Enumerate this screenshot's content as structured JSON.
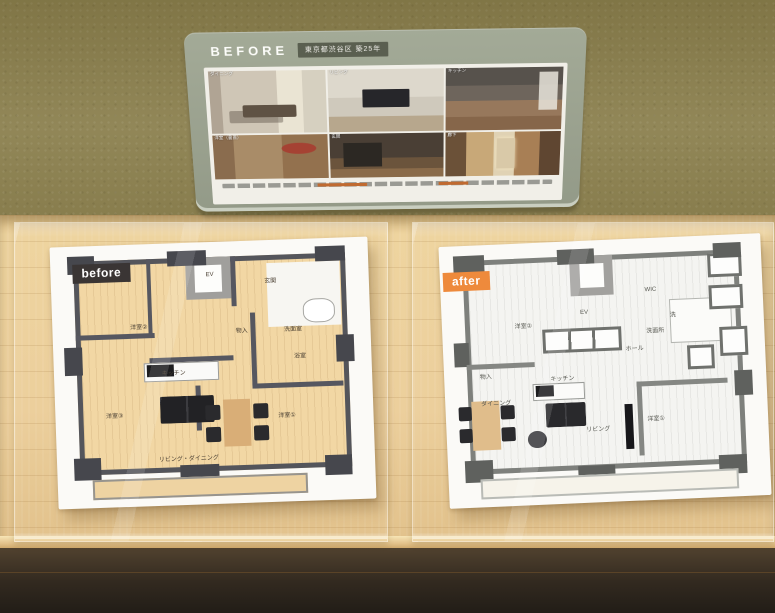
{
  "panel": {
    "title": "BEFORE",
    "badge": "東京都渋谷区 築25年",
    "photos": [
      {
        "label": "ダイニング"
      },
      {
        "label": "リビング"
      },
      {
        "label": "キッチン"
      },
      {
        "label": "洋室（書斎）"
      },
      {
        "label": "玄関"
      },
      {
        "label": "廊下"
      }
    ]
  },
  "models": {
    "before": {
      "badge": "before",
      "rooms": [
        {
          "label": "洋室②",
          "x": 26,
          "y": 30
        },
        {
          "label": "EV",
          "x": 50,
          "y": 10
        },
        {
          "label": "玄関",
          "x": 70,
          "y": 13
        },
        {
          "label": "物入",
          "x": 60,
          "y": 33
        },
        {
          "label": "洗面室",
          "x": 77,
          "y": 33
        },
        {
          "label": "浴室",
          "x": 79,
          "y": 44
        },
        {
          "label": "洋室①",
          "x": 74,
          "y": 68
        },
        {
          "label": "洋室③",
          "x": 17,
          "y": 66
        },
        {
          "label": "キッチン",
          "x": 37,
          "y": 49
        },
        {
          "label": "リビング・ダイニング",
          "x": 41,
          "y": 84
        }
      ]
    },
    "after": {
      "badge": "after",
      "rooms": [
        {
          "label": "洋室②",
          "x": 24,
          "y": 30
        },
        {
          "label": "EV",
          "x": 44,
          "y": 26
        },
        {
          "label": "WIC",
          "x": 66,
          "y": 18
        },
        {
          "label": "洗",
          "x": 73,
          "y": 28
        },
        {
          "label": "洗面所",
          "x": 67,
          "y": 34
        },
        {
          "label": "ホール",
          "x": 60,
          "y": 41
        },
        {
          "label": "物入",
          "x": 11,
          "y": 50
        },
        {
          "label": "キッチン",
          "x": 36,
          "y": 52
        },
        {
          "label": "ダイニング",
          "x": 14,
          "y": 61
        },
        {
          "label": "リビング",
          "x": 47,
          "y": 73
        },
        {
          "label": "洋室①",
          "x": 66,
          "y": 70
        }
      ]
    }
  },
  "colors": {
    "wall": "#8d8251",
    "panel": "#9aa28f",
    "panel_badge": "#5a5f50",
    "before_badge": "#3a3534",
    "after_badge": "#ee8a3c",
    "shelf_wood": "#ecd09e",
    "floor_dark": "#2e2620",
    "plan_before_floor": "#f2d7a4",
    "plan_before_wall": "#54555b",
    "plan_after_wall": "#7e807c"
  }
}
